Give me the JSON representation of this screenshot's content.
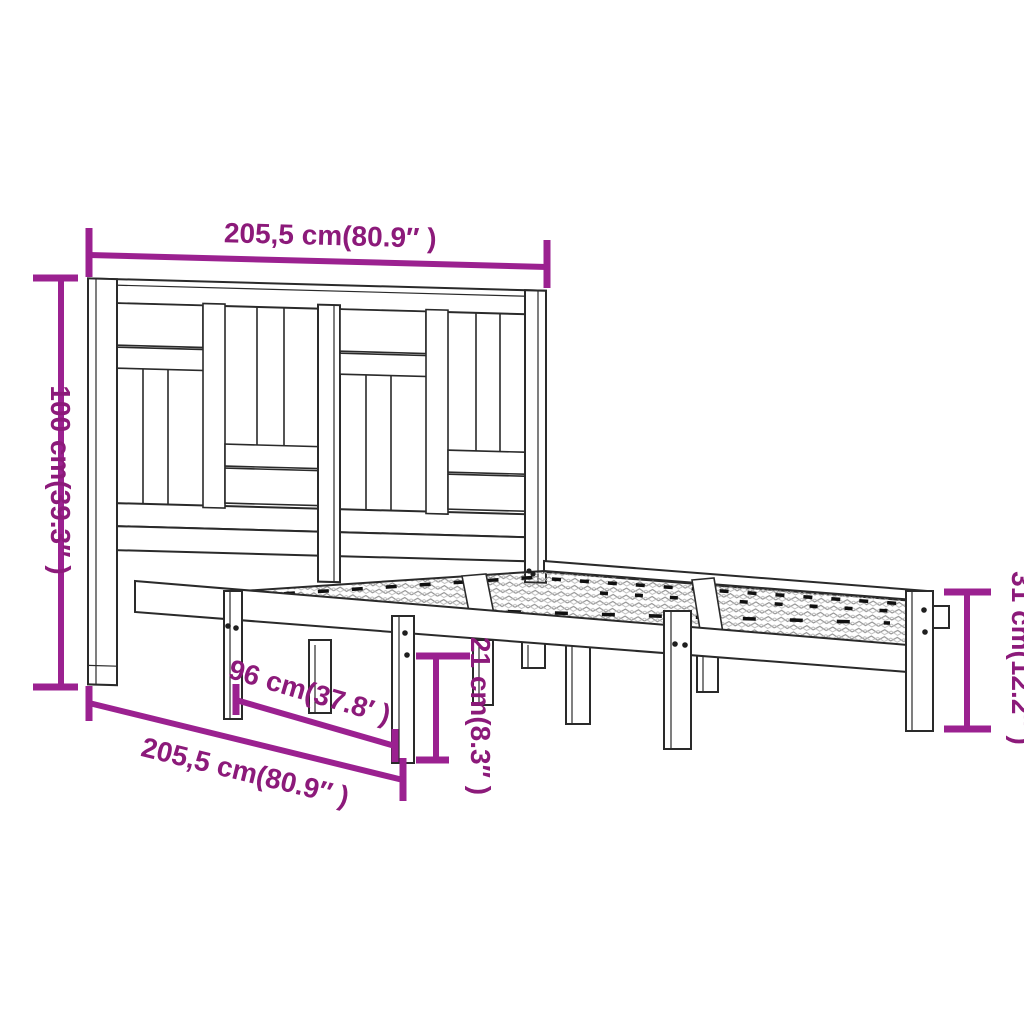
{
  "diagram": {
    "type": "furniture-dimension-diagram",
    "subject": "wood bed frame with slatted headboard",
    "background_color": "#ffffff",
    "outline_color": "#2a2a2a",
    "hatch_color": "#8f8f8f",
    "accent_line_color": "#9B2190",
    "accent_text_color": "#8C1A7A",
    "dimensions": {
      "width_top": {
        "label": "205,5 cm(80.9″ )",
        "cm": "205,5",
        "inch": "80.9"
      },
      "height_left": {
        "label": "100 cm(39.3″ )",
        "cm": "100",
        "inch": "39.3"
      },
      "foot_height": {
        "label": "31 cm(12.2″ )",
        "cm": "31",
        "inch": "12.2"
      },
      "base_height": {
        "label": "21 cm(8.3″ )",
        "cm": "21",
        "inch": "8.3"
      },
      "inner_length": {
        "label": "96 cm(37.8′ )",
        "cm": "96",
        "inch": "37.8"
      },
      "length_bottom": {
        "label": "205,5 cm(80.9″ )",
        "cm": "205,5",
        "inch": "80.9"
      }
    }
  }
}
